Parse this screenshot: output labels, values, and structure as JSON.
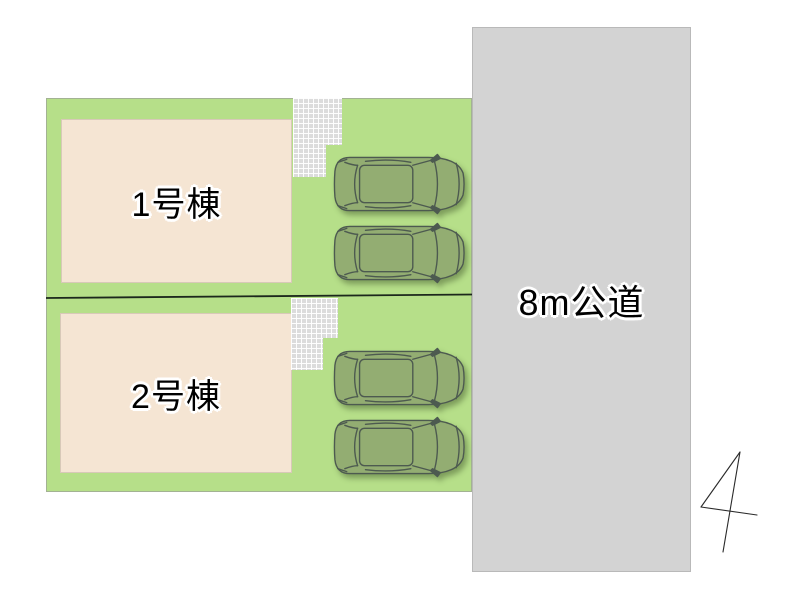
{
  "plan": {
    "lots": [
      {
        "building_label": "1号棟",
        "car_count": 2
      },
      {
        "building_label": "2号棟",
        "car_count": 2
      }
    ],
    "road": {
      "label": "8m公道"
    },
    "compass": {
      "type": "north-arrow"
    },
    "colors": {
      "lawn": "#b6df89",
      "building": "#f5e5d3",
      "building_border": "#d8c9b8",
      "tiles": "#dcdcdc",
      "road": "#d3d3d3",
      "road_border": "#b9b9b9",
      "car_body": "#93ad72",
      "car_outline": "#4d5a50",
      "lot_divider": "#1c281c",
      "text": "#000000",
      "text_halo": "#ffffff"
    }
  }
}
